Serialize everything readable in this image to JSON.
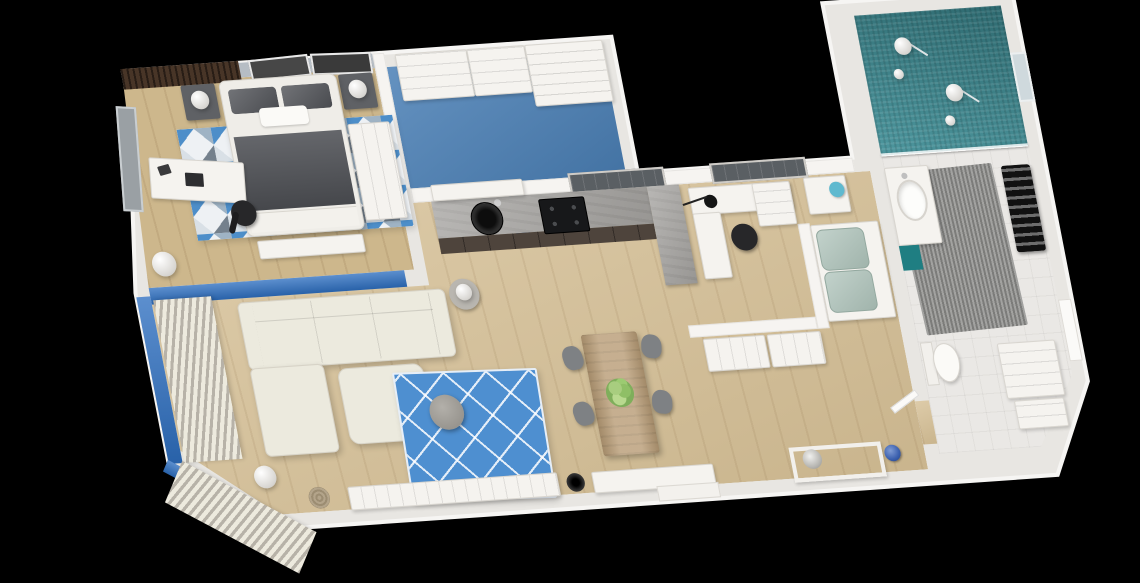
{
  "scene": {
    "type": "3d-floor-plan-render",
    "view": "top-down-perspective",
    "background": "#000000",
    "text_visible": false
  },
  "palette": {
    "outer-wall": "#e8e6e2",
    "outer-wall-edge": "#f6f5f3",
    "wall-face": "#f6f4f1",
    "wood-floor": "#d6c096",
    "wood-floor-dark": "#cdb78c",
    "closet-floor-blue": "#4b80b6",
    "accent-wall-blue": "#2e6fc0",
    "rug-blue": "#4e8fd0",
    "shower-teal": "#3e8e96",
    "teal-cabinet": "#1f7e82",
    "mint-sofa": "#aec3ba",
    "counter-grey": "#a5a3a0",
    "cabinet-dark": "#4e443c",
    "mat-grey": "#8d8d8b",
    "sofa-cream": "#eceade",
    "dark-bedding": "#53555a",
    "slat-wood": "#483527",
    "chair-grey": "#7e8184",
    "lamp-teal": "#5fb9cf",
    "vase-blue": "#3a5fae",
    "window-dark": "#5a5f63",
    "black": "#1c1c1e"
  },
  "rooms": {
    "bedroom": {
      "label": "Bedroom",
      "floor": "wood",
      "furniture": [
        "double bed with dark grey bedding",
        "two dark nightstands with white ball lamps",
        "geometric triangle rug",
        "white desk with laptop",
        "black office chair",
        "tall white wardrobe",
        "grey roller blind",
        "two dark wall art frames",
        "dark wood slat wall band",
        "white floor lamp",
        "foot bench"
      ]
    },
    "walk_in_closet": {
      "label": "Walk-in closet",
      "floor": "blue carpet",
      "furniture": [
        "white drawer units",
        "open shelving unit"
      ]
    },
    "kitchen": {
      "label": "Kitchen",
      "floor": "wood",
      "furniture": [
        "grey L-shaped concrete counter",
        "round black sink",
        "black 4-burner gas hob",
        "dark base cabinets",
        "white upper cabinet",
        "dark window above counter",
        "blue wall stub"
      ]
    },
    "home_office": {
      "label": "Home office",
      "floor": "wood",
      "furniture": [
        "white corner desk with drawer unit",
        "black office chair",
        "black pendant lamp",
        "dark window"
      ]
    },
    "guest_room": {
      "label": "Guest nook",
      "floor": "wood",
      "furniture": [
        "mint green loveseat",
        "white cabinet",
        "teal table lamp",
        "low white sideboards"
      ]
    },
    "bathroom": {
      "label": "Bathroom",
      "floor": "tile",
      "furniture": [
        "teal mosaic double shower with two shower heads",
        "glass partition",
        "white vanity with oval sink",
        "teal vanity cabinet",
        "toilet",
        "black towel radiator",
        "grey textured mat",
        "washer cabinet stack",
        "drawer unit",
        "wall window"
      ]
    },
    "living_room": {
      "label": "Living room",
      "floor": "wood",
      "furniture": [
        "cream corner sofa with chaise",
        "square ottoman",
        "blue lattice rug",
        "round grey coffee table",
        "striped floor-to-ceiling curtains",
        "blue accent wall",
        "white ball floor lamp",
        "woven basket",
        "white TV sideboard",
        "black floor vase",
        "round side table with ball lamp"
      ]
    },
    "dining_area": {
      "label": "Dining area",
      "floor": "wood",
      "furniture": [
        "wooden dining table",
        "four grey shell chairs",
        "green plant centerpiece"
      ]
    },
    "hallway": {
      "label": "Hallway",
      "floor": "wood",
      "furniture": [
        "white console table",
        "silver bowl",
        "blue patterned vase",
        "entry sideboard",
        "white door in right wall"
      ]
    }
  }
}
